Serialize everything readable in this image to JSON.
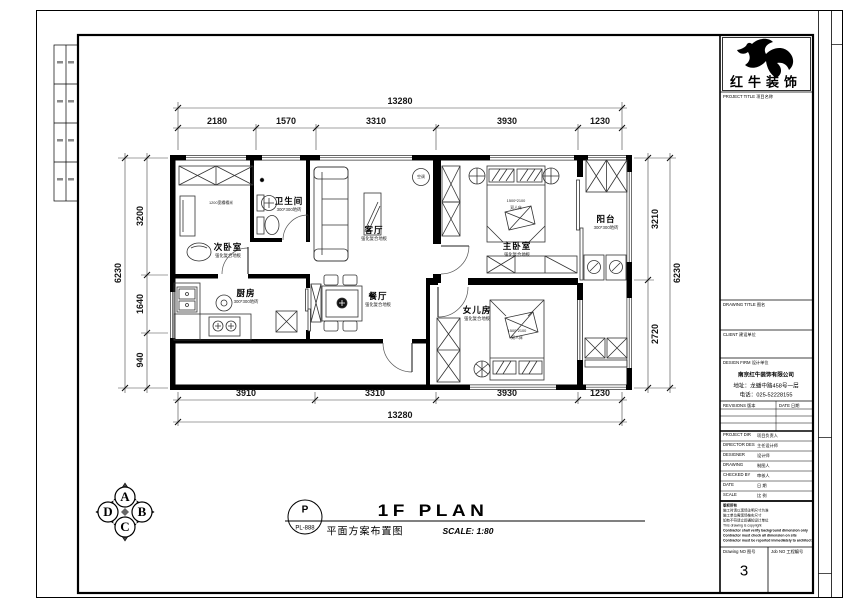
{
  "brand": {
    "name": "红牛装饰"
  },
  "titleblock": {
    "project_label": "PROJECT TITLE 项目名称",
    "drawing_label": "DRAWING TITLE 图名",
    "client_label": "CLIENT 建设单位",
    "firm_label": "DESIGN FIRM 设计单位",
    "firm_name": "南京红牛装饰有限公司",
    "firm_address": "地址：龙蟠中路458号一层",
    "firm_phone": "电话：025-52228155",
    "revisions_label": "REVISIONS 版本",
    "date_label": "DATE 日期",
    "credits": [
      {
        "label": "PROJECT DIR",
        "value": "项目负责人"
      },
      {
        "label": "DIRECTOR DES",
        "value": "主任设计师"
      },
      {
        "label": "DESIGNER",
        "value": "设计师"
      },
      {
        "label": "DRAWING",
        "value": "制图人"
      },
      {
        "label": "CHECKED BY",
        "value": "审核人"
      },
      {
        "label": "DATE",
        "value": "日 期"
      },
      {
        "label": "SCALE",
        "value": "比 例"
      }
    ],
    "notes_title": "版权所有",
    "notes": [
      "施工时请以现场注明尺寸为准",
      "施工单位需现场核实尺寸",
      "如有不符请立即通知设计单位",
      "This drawing is copyright",
      "Contractor shall verify background dimension only",
      "Contractor must check all dimension on site",
      "Contractor must be reported immediately to architect"
    ],
    "drawing_no_label": "Drawing NO 图号",
    "drawing_no": "3",
    "job_no_label": "Job NO 工程编号"
  },
  "titlebar": {
    "stamp_letter": "P",
    "stamp_code": "PL-888",
    "title_en": "1F PLAN",
    "title_cn": "平面方案布置图",
    "scale": "SCALE: 1:80"
  },
  "compass": {
    "n": "A",
    "e": "B",
    "s": "C",
    "w": "D"
  },
  "plan": {
    "rooms": [
      {
        "name": "次卧室",
        "floor": "强化复合地板"
      },
      {
        "name": "卫生间",
        "floor": "300*300地砖"
      },
      {
        "name": "客厅",
        "floor": "强化复合地板"
      },
      {
        "name": "主卧室",
        "floor": "强化复合地板"
      },
      {
        "name": "阳台",
        "floor": "300*300地砖"
      },
      {
        "name": "厨房",
        "floor": "300*300地砖"
      },
      {
        "name": "餐厅",
        "floor": "强化复合地板"
      },
      {
        "name": "女儿房",
        "floor": "强化复合地板"
      }
    ],
    "labels": {
      "ac": "空调",
      "tatami": "1200宽榻榻米",
      "bed_size": "1500*2100",
      "bed_type": "双人床"
    },
    "dims": {
      "top_total": "13280",
      "top_segments": [
        "2180",
        "1570",
        "3310",
        "3930",
        "1230"
      ],
      "bottom_segments": [
        "3910",
        "3310",
        "3930",
        "1230"
      ],
      "bottom_total": "13280",
      "left_segments": [
        "3200",
        "1640",
        "940"
      ],
      "left_total": "6230",
      "right_segments": [
        "3210",
        "2720"
      ],
      "right_total": "6230"
    }
  }
}
